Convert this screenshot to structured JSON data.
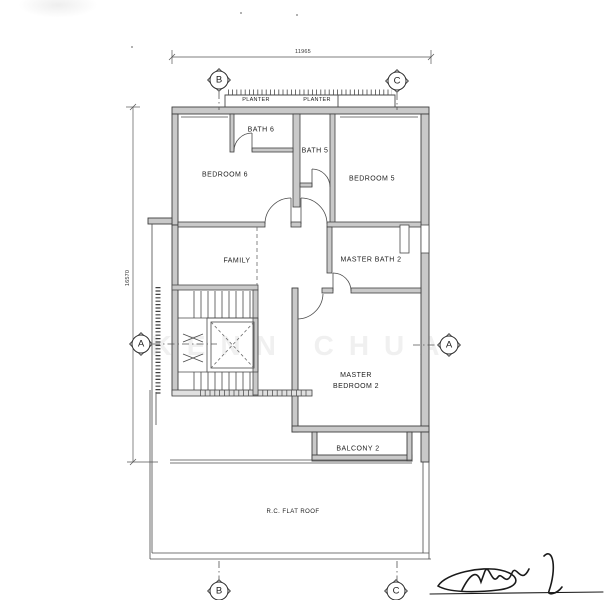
{
  "drawing": {
    "rooms": {
      "planter_left": "PLANTER",
      "planter_right": "PLANTER",
      "bath_6": "BATH 6",
      "bath_5": "BATH 5",
      "bedroom_6": "BEDROOM 6",
      "bedroom_5": "BEDROOM 5",
      "family": "FAMILY",
      "master_bath_2": "MASTER BATH 2",
      "master_bedroom_2_line1": "MASTER",
      "master_bedroom_2_line2": "BEDROOM 2",
      "balcony_2": "BALCONY 2",
      "roof": "R.C. FLAT ROOF"
    },
    "dimensions": {
      "top_width": "11965",
      "left_height": "16570"
    },
    "grid": {
      "b_top": "B",
      "c_top": "C",
      "a_left": "A",
      "a_right": "A",
      "b_bottom": "B",
      "c_bottom": "C"
    },
    "watermark": "KENN CHUA",
    "colors": {
      "line": "#3f3f3f",
      "wall_fill": "#c9c9c9",
      "ink": "#1a1a1a"
    }
  }
}
